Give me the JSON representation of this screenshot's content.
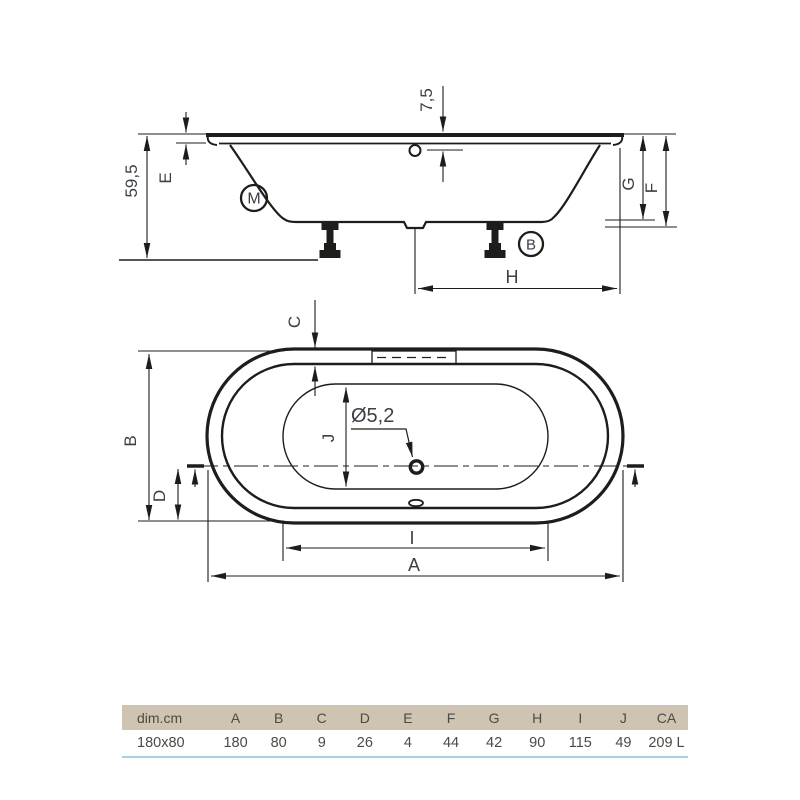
{
  "drawing": {
    "side_view": {
      "total_height": "59,5",
      "rim_edge_label": "E",
      "overflow_offset": "7,5",
      "mixer_mark": "M",
      "drain_mark": "B",
      "inner_depth_label": "G",
      "body_height_label": "F",
      "drain_distance_label": "H"
    },
    "top_view": {
      "rim_width_label": "C",
      "overall_width_label": "B",
      "drain_offset_label": "D",
      "inner_width_label": "J",
      "drain_diameter": "Ø5,2",
      "inner_length_label": "I",
      "overall_length_label": "A"
    }
  },
  "table": {
    "headers": [
      "dim.cm",
      "A",
      "B",
      "C",
      "D",
      "E",
      "F",
      "G",
      "H",
      "I",
      "J",
      "CA"
    ],
    "row": [
      "180x80",
      "180",
      "80",
      "9",
      "26",
      "4",
      "44",
      "42",
      "90",
      "115",
      "49",
      "209 L"
    ]
  },
  "colors": {
    "ink": "#1d1d1b",
    "dim_text": "#3a4046",
    "table_header_bg": "#cfc3b2",
    "table_text": "#4b4a45",
    "accent_rule": "#a6d3e2",
    "background": "#ffffff"
  }
}
